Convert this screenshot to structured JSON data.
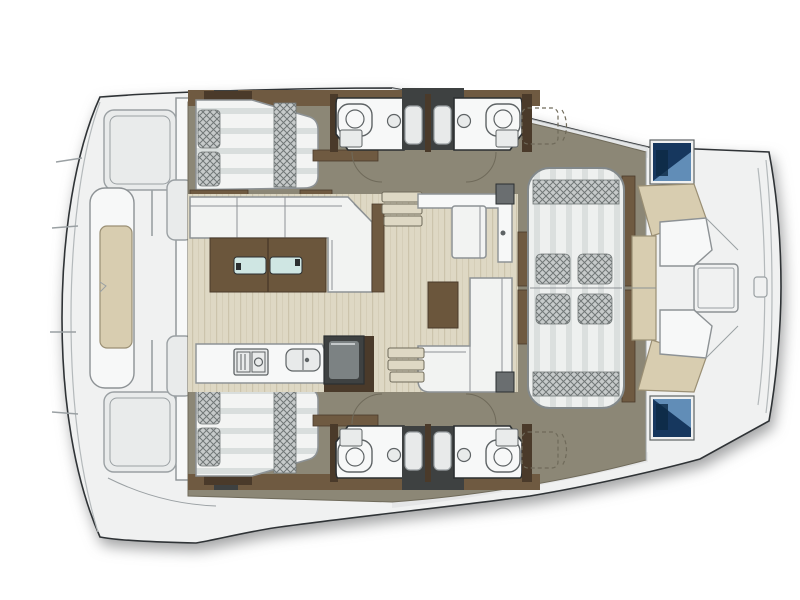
{
  "palette": {
    "bg": "#ffffff",
    "hull": "#f0f1f1",
    "hull-stroke": "#2f3336",
    "deck-shade": "#dde0e1",
    "deck-line": "#9aa0a3",
    "rim-line": "#b4b9bb",
    "olive": "#8c8776",
    "olive-dark": "#6f6a5a",
    "wood-floor": "#ded8c4",
    "wood-grain": "#ccc4ac",
    "brown": "#6f5a41",
    "brown-dark": "#4a3a2a",
    "table-wood": "#6b563c",
    "mattress": "#f3f4f3",
    "mattress-stripe": "#d9dedd",
    "stripe-light": "#eef0ef",
    "stripe-dark": "#dbdfde",
    "checker-base": "#c6caca",
    "checker-line": "#717777",
    "sofa": "#f2f3f2",
    "sofa-line": "#8d9295",
    "white-room": "#f7f8f8",
    "fixture": "#e9ebeb",
    "fixture-stroke": "#5e6365",
    "charcoal": "#3e4141",
    "tray": "#e8eaea",
    "navy": "#16375e",
    "screen-blue": "#6e9cc7",
    "beige": "#d8cdb0",
    "beige-stroke": "#9a8f74",
    "glass": "#cfe6e3",
    "dark": "#2b2f31",
    "hatch-grey": "#787a6e"
  },
  "diagram": {
    "type": "boat-floor-plan",
    "vessel": "catamaran",
    "view": "top-down",
    "regions": {
      "stern_deck": {
        "icons": [
          "transom-lounger",
          "lounger-cushion",
          "deck-panel",
          "deck-panel",
          "boarding-step",
          "boarding-step"
        ]
      },
      "port_cabin": {
        "icons": [
          "double-berth",
          "pillow",
          "pillow",
          "blanket-runner",
          "headboard"
        ]
      },
      "starboard_cabin": {
        "icons": [
          "double-berth",
          "pillow",
          "pillow",
          "blanket-runner",
          "headboard"
        ]
      },
      "port_head": {
        "icons": [
          "toilet",
          "washbasin",
          "shower-stall",
          "door-swing"
        ]
      },
      "starboard_head": {
        "icons": [
          "toilet",
          "washbasin",
          "shower-stall",
          "door-swing"
        ]
      },
      "salon": {
        "icons": [
          "l-sofa",
          "dining-table",
          "glass-insert",
          "glass-insert",
          "l-sofa",
          "side-table",
          "bench-seat",
          "counter",
          "stairs-down",
          "stairs-down",
          "door-post",
          "door-post",
          "storage-dashed",
          "storage-dashed"
        ]
      },
      "galley": {
        "icons": [
          "counter",
          "two-burner-stove",
          "double-sink",
          "top-load-cooler"
        ]
      },
      "forward_cockpit": {
        "icons": [
          "lounge-pad",
          "bolster",
          "bolster",
          "seat-cushion",
          "seat-cushion",
          "seat-cushion",
          "seat-cushion",
          "side-rail",
          "side-rail"
        ]
      },
      "foredeck": {
        "icons": [
          "forward-window",
          "forward-window",
          "bench-frame",
          "bench-frame",
          "bench-cushion",
          "bench-cushion",
          "deck-hatch",
          "bow-tip",
          "bow-tip",
          "rim-cleat"
        ]
      }
    }
  }
}
